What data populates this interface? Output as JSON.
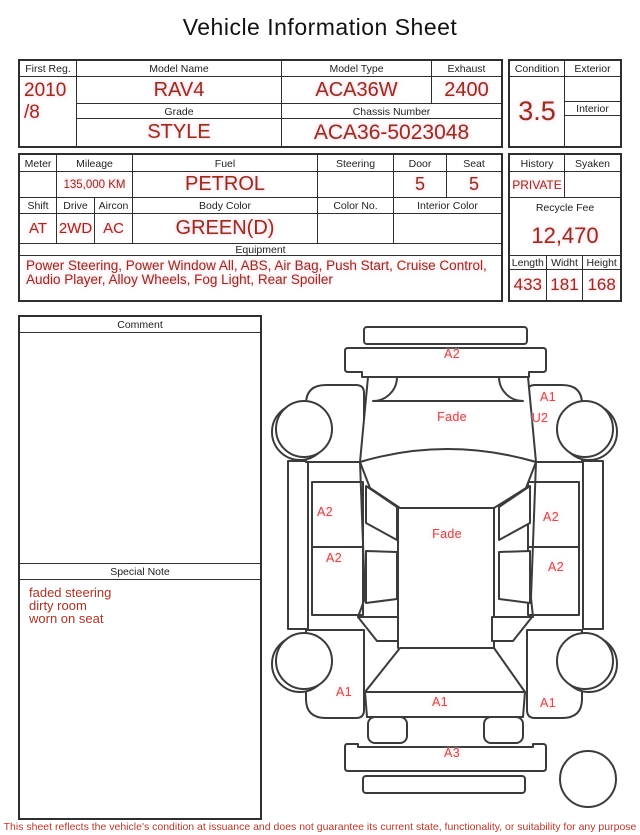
{
  "title": "Vehicle Information Sheet",
  "table1": {
    "first_reg": {
      "label": "First Reg.",
      "value": "2010\n/8"
    },
    "model_name": {
      "label": "Model Name",
      "value": "RAV4"
    },
    "model_type": {
      "label": "Model Type",
      "value": "ACA36W"
    },
    "exhaust": {
      "label": "Exhaust",
      "value": "2400"
    },
    "grade": {
      "label": "Grade",
      "value": "STYLE"
    },
    "chassis_number": {
      "label": "Chassis Number",
      "value": "ACA36-5023048"
    }
  },
  "condition_box": {
    "condition": {
      "label": "Condition",
      "value": "3.5"
    },
    "exterior": {
      "label": "Exterior",
      "value": ""
    },
    "interior": {
      "label": "Interior",
      "value": ""
    }
  },
  "table2": {
    "meter": {
      "label": "Meter",
      "value": ""
    },
    "mileage": {
      "label": "Mileage",
      "value": "135,000 KM"
    },
    "fuel": {
      "label": "Fuel",
      "value": "PETROL"
    },
    "steering": {
      "label": "Steering",
      "value": ""
    },
    "door": {
      "label": "Door",
      "value": "5"
    },
    "seat": {
      "label": "Seat",
      "value": "5"
    },
    "shift": {
      "label": "Shift",
      "value": "AT"
    },
    "drive": {
      "label": "Drive",
      "value": "2WD"
    },
    "aircon": {
      "label": "Aircon",
      "value": "AC"
    },
    "body_color": {
      "label": "Body Color",
      "value": "GREEN(D)"
    },
    "color_no": {
      "label": "Color No.",
      "value": ""
    },
    "interior_color": {
      "label": "Interior Color",
      "value": ""
    },
    "equipment": {
      "label": "Equipment",
      "value": "Power Steering, Power Window  All, ABS, Air Bag, Push Start, Cruise Control, Audio Player, Alloy Wheels, Fog Light, Rear Spoiler"
    }
  },
  "history_box": {
    "history": {
      "label": "History",
      "value": "PRIVATE"
    },
    "syaken": {
      "label": "Syaken",
      "value": ""
    },
    "recycle_fee": {
      "label": "Recycle Fee",
      "value": "12,470"
    },
    "length": {
      "label": "Length",
      "value": "433"
    },
    "width": {
      "label": "Widht",
      "value": "181"
    },
    "height": {
      "label": "Height",
      "value": "168"
    }
  },
  "comment_box": {
    "comment_label": "Comment",
    "comment_value": "",
    "special_note_label": "Special Note",
    "special_note_value": "faded steering\ndirty room\nworn on seat"
  },
  "diagram": {
    "labels": [
      {
        "text": "A2",
        "x": 452,
        "y": 354
      },
      {
        "text": "Fade",
        "x": 452,
        "y": 417
      },
      {
        "text": "A1",
        "x": 548,
        "y": 397
      },
      {
        "text": "U2",
        "x": 540,
        "y": 418
      },
      {
        "text": "A2",
        "x": 325,
        "y": 512
      },
      {
        "text": "A2",
        "x": 551,
        "y": 517
      },
      {
        "text": "Fade",
        "x": 447,
        "y": 534
      },
      {
        "text": "A2",
        "x": 334,
        "y": 558
      },
      {
        "text": "A2",
        "x": 556,
        "y": 567
      },
      {
        "text": "A1",
        "x": 344,
        "y": 692
      },
      {
        "text": "A1",
        "x": 440,
        "y": 702
      },
      {
        "text": "A1",
        "x": 548,
        "y": 703
      },
      {
        "text": "A3",
        "x": 452,
        "y": 753
      }
    ]
  },
  "footer": {
    "disclaimer": "This sheet reflects the vehicle's condition at issuance and does not guarantee its current state, functionality, or suitability for any purpose"
  },
  "colors": {
    "value_red": "#8c3222",
    "label_black": "#1f1f1f",
    "border_dark": "#2e2e2e",
    "highlight_pink": "#ffc9da",
    "diagram_red": "#c0564c",
    "footer_red": "#b2392e",
    "note_red": "#a33628"
  }
}
